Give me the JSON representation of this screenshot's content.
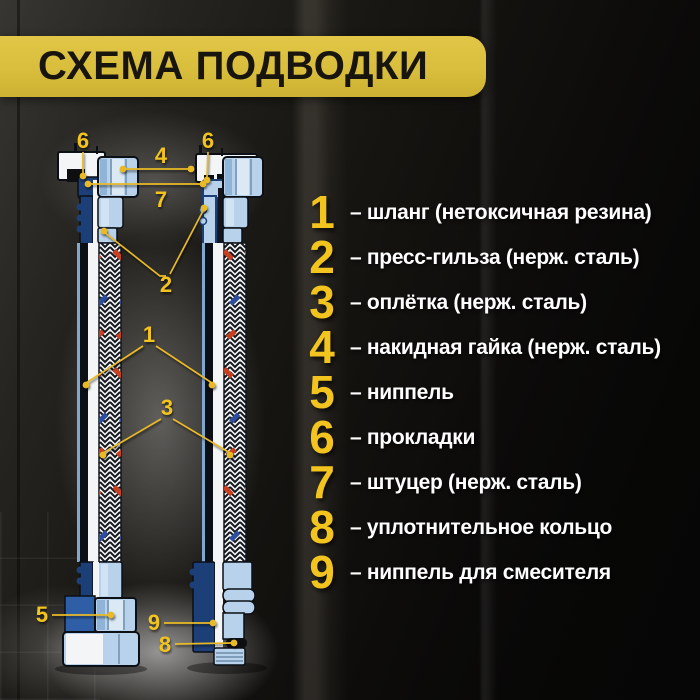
{
  "title": "СХЕМА ПОДВОДКИ",
  "colors": {
    "banner": "#d9bd3c",
    "bannerText": "#17150e",
    "gold": "#f2c41d",
    "calloutGold": "#e9ba26",
    "legendText": "#ffffff",
    "lightBlue": "#b7d2ea",
    "lightBlueHi": "#dbe9f5",
    "lightBlueShade": "#8fb4d8",
    "navy": "#1d3f78",
    "blueMid": "#2e5fa6",
    "outline": "#0b0f16",
    "paperWhite": "#f3f5f7",
    "braidRed": "#c8401f",
    "braidBlue": "#2d4d9e",
    "braidInk": "#15181d"
  },
  "legend": {
    "items": [
      {
        "num": "1",
        "label": "– шланг (нетоксичная резина)"
      },
      {
        "num": "2",
        "label": "– пресс-гильза (нерж. сталь)"
      },
      {
        "num": "3",
        "label": "– оплётка (нерж. сталь)"
      },
      {
        "num": "4",
        "label": "– накидная гайка (нерж. сталь)"
      },
      {
        "num": "5",
        "label": "– ниппель"
      },
      {
        "num": "6",
        "label": "– прокладки"
      },
      {
        "num": "7",
        "label": "– штуцер (нерж. сталь)"
      },
      {
        "num": "8",
        "label": "– уплотнительное кольцо"
      },
      {
        "num": "9",
        "label": "– ниппель для смесителя"
      }
    ]
  },
  "diagram": {
    "callouts": [
      {
        "text": "6"
      },
      {
        "text": "6"
      },
      {
        "text": "4"
      },
      {
        "text": "7"
      },
      {
        "text": "2"
      },
      {
        "text": "1"
      },
      {
        "text": "3"
      },
      {
        "text": "5"
      },
      {
        "text": "9"
      },
      {
        "text": "8"
      }
    ]
  }
}
